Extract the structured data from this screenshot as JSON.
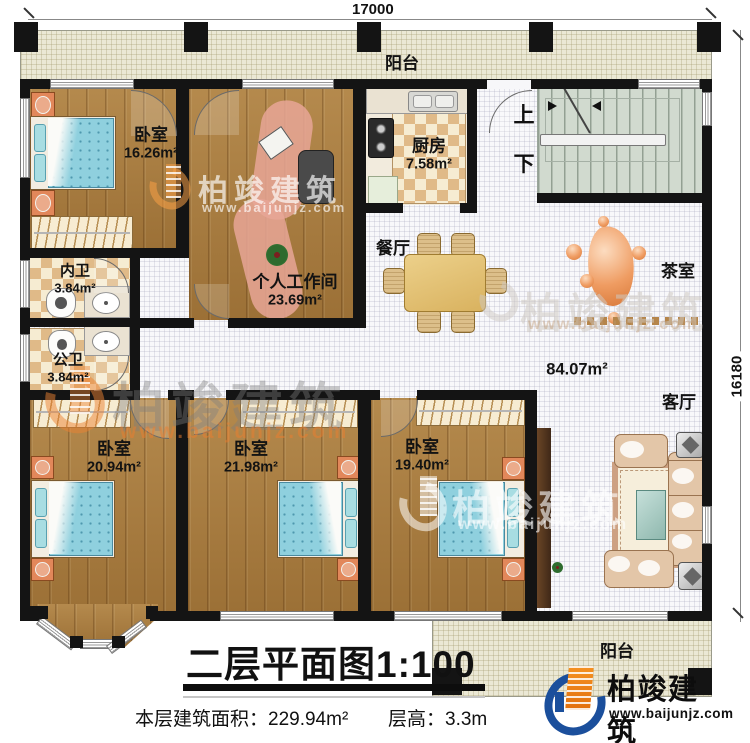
{
  "meta": {
    "plan_title": "二层平面图",
    "plan_scale": "1:100",
    "area_label": "本层建筑面积：",
    "area_value": "229.94m²",
    "floor_height_label": "层高：",
    "floor_height_value": "3.3m"
  },
  "dimensions": {
    "top_width": "17000",
    "right_height": "16180"
  },
  "rooms": {
    "balcony_top": {
      "name": "阳台"
    },
    "bedroom1": {
      "name": "卧室",
      "area": "16.26m²"
    },
    "workroom": {
      "name": "个人工作间",
      "area": "23.69m²"
    },
    "kitchen": {
      "name": "厨房",
      "area": "7.58m²"
    },
    "dining": {
      "name": "餐厅"
    },
    "tea_room": {
      "name": "茶室"
    },
    "hall": {
      "area": "84.07m²"
    },
    "living": {
      "name": "客厅"
    },
    "bath_inner": {
      "name": "内卫",
      "area": "3.84m²"
    },
    "bath_public": {
      "name": "公卫",
      "area": "3.84m²"
    },
    "bedroom2": {
      "name": "卧室",
      "area": "20.94m²"
    },
    "bedroom3": {
      "name": "卧室",
      "area": "21.98m²"
    },
    "bedroom4": {
      "name": "卧室",
      "area": "19.40m²"
    },
    "balcony_bottom": {
      "name": "阳台"
    }
  },
  "stairs": {
    "up_label": "上",
    "down_label": "下"
  },
  "brand": {
    "name": "柏竣建筑",
    "website": "www.baijunjz.com"
  },
  "colors": {
    "wall": "#141414",
    "wood_floor": "#ac7e3f",
    "tile_accent": "#e0ba88",
    "stair_floor": "#d1dacf",
    "bed_blue": "#8fd0de",
    "brand_blue": "#1b4f9c",
    "brand_orange": "#f08020",
    "watermark_orange": "#e07820"
  }
}
